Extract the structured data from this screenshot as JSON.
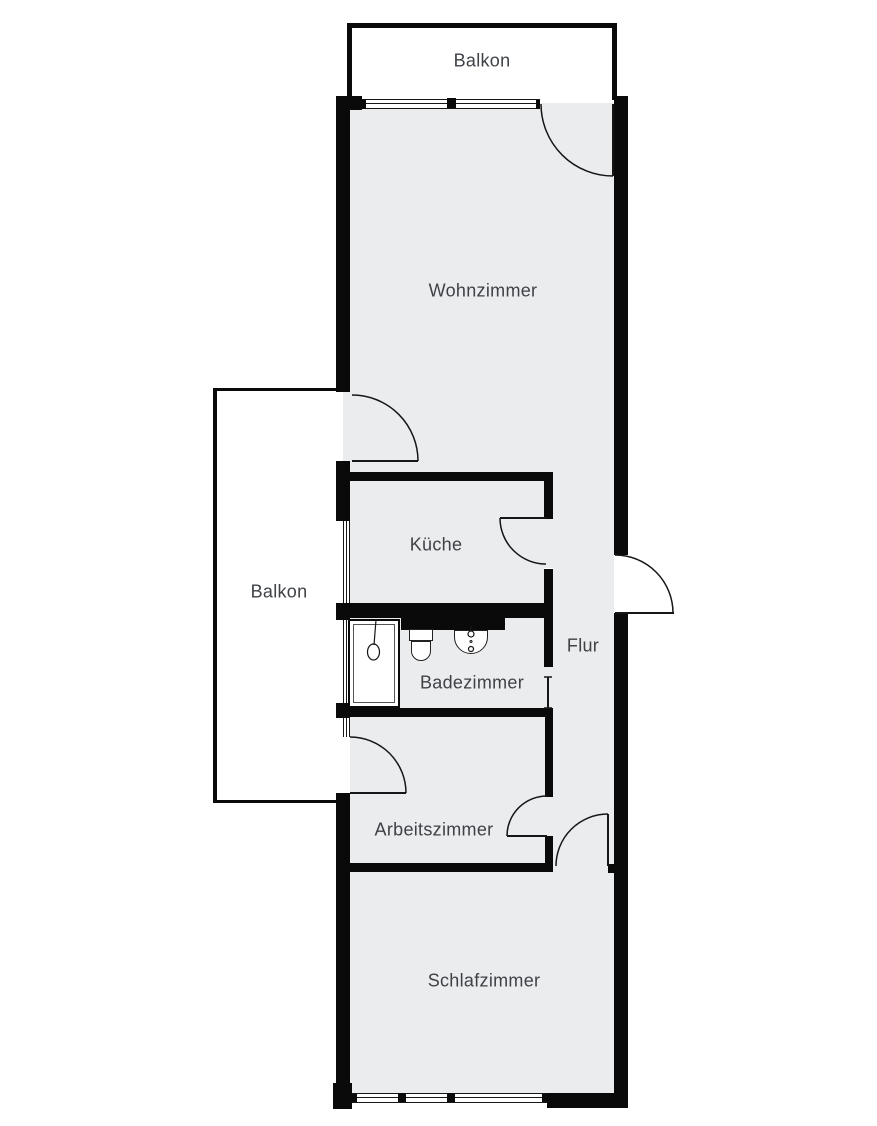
{
  "floorplan": {
    "rooms": [
      {
        "id": "balkon-top",
        "label": "Balkon"
      },
      {
        "id": "wohnzimmer",
        "label": "Wohnzimmer"
      },
      {
        "id": "balkon-links",
        "label": "Balkon"
      },
      {
        "id": "kueche",
        "label": "Küche"
      },
      {
        "id": "badezimmer",
        "label": "Badezimmer"
      },
      {
        "id": "flur",
        "label": "Flur"
      },
      {
        "id": "arbeitszimmer",
        "label": "Arbeitszimmer"
      },
      {
        "id": "schlafzimmer",
        "label": "Schlafzimmer"
      }
    ],
    "fixture_icons": [
      "shower-icon",
      "toilet-icon",
      "sink-icon",
      "counter-block"
    ],
    "door_count": 8,
    "window_count": 5,
    "colors": {
      "wall": "#0a0a0a",
      "floor": "#ebecee",
      "balcony_fill": "#ffffff",
      "label_text": "#3e4247",
      "line": "#161616"
    }
  }
}
